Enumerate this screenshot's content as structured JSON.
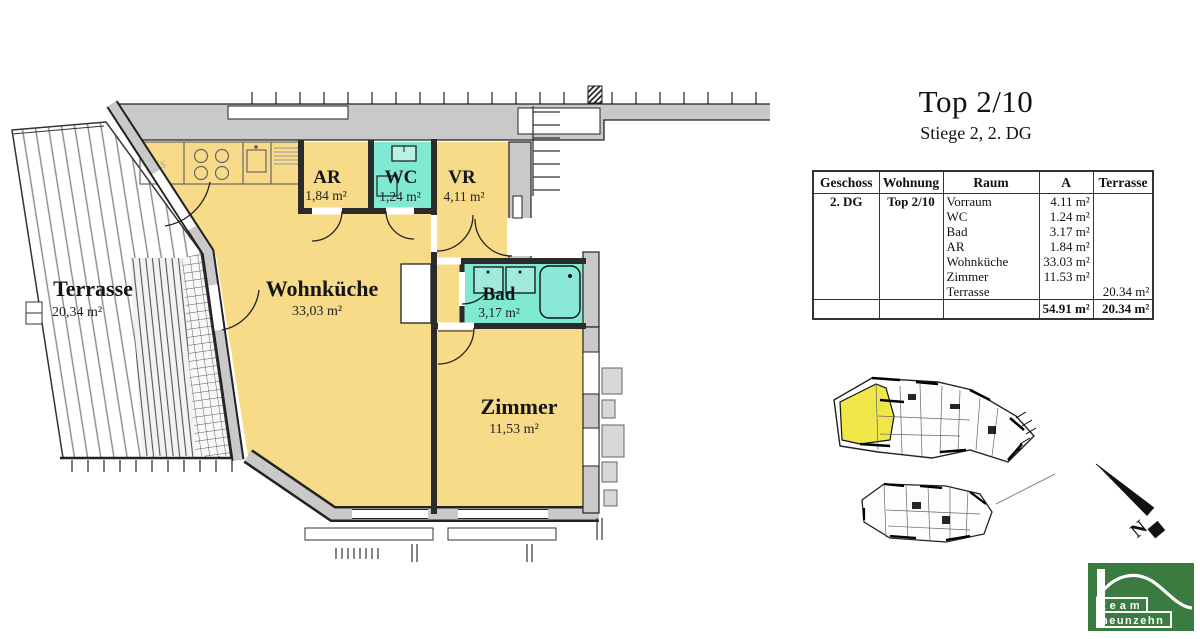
{
  "title_block": {
    "title": "Top 2/10",
    "subtitle": "Stiege 2, 2. DG"
  },
  "table": {
    "headers": [
      "Geschoss",
      "Wohnung",
      "Raum",
      "A",
      "Terrasse"
    ],
    "rows": [
      {
        "geschoss": "2. DG",
        "wohnung": "Top 2/10",
        "raum": "Vorraum",
        "a": "4.11 m²",
        "terrasse": ""
      },
      {
        "geschoss": "",
        "wohnung": "",
        "raum": "WC",
        "a": "1.24 m²",
        "terrasse": ""
      },
      {
        "geschoss": "",
        "wohnung": "",
        "raum": "Bad",
        "a": "3.17 m²",
        "terrasse": ""
      },
      {
        "geschoss": "",
        "wohnung": "",
        "raum": "AR",
        "a": "1.84 m²",
        "terrasse": ""
      },
      {
        "geschoss": "",
        "wohnung": "",
        "raum": "Wohnküche",
        "a": "33.03 m²",
        "terrasse": ""
      },
      {
        "geschoss": "",
        "wohnung": "",
        "raum": "Zimmer",
        "a": "11.53 m²",
        "terrasse": ""
      },
      {
        "geschoss": "",
        "wohnung": "",
        "raum": "Terrasse",
        "a": "",
        "terrasse": "20.34 m²"
      }
    ],
    "total_a": "54.91 m²",
    "total_terrasse": "20.34 m²"
  },
  "plan": {
    "rooms": [
      {
        "name": "Terrasse",
        "area": "20,34 m²"
      },
      {
        "name": "Wohnküche",
        "area": "33,03 m²"
      },
      {
        "name": "AR",
        "area": "1,84 m²"
      },
      {
        "name": "WC",
        "area": "1,24 m²"
      },
      {
        "name": "VR",
        "area": "4,11 m²"
      },
      {
        "name": "Bad",
        "area": "3,17 m²"
      },
      {
        "name": "Zimmer",
        "area": "11,53 m²"
      }
    ],
    "kitchen_label": "KS",
    "colors": {
      "room_yellow": "#f7db88",
      "wet_teal": "#7fe9d1",
      "wall_gray": "#c9c9c9",
      "key_plan_highlight": "#efe74a"
    }
  },
  "compass": {
    "label": "N"
  },
  "logo": {
    "line1": "team",
    "line2": "neunzehn",
    "green": "#3a7b40"
  }
}
